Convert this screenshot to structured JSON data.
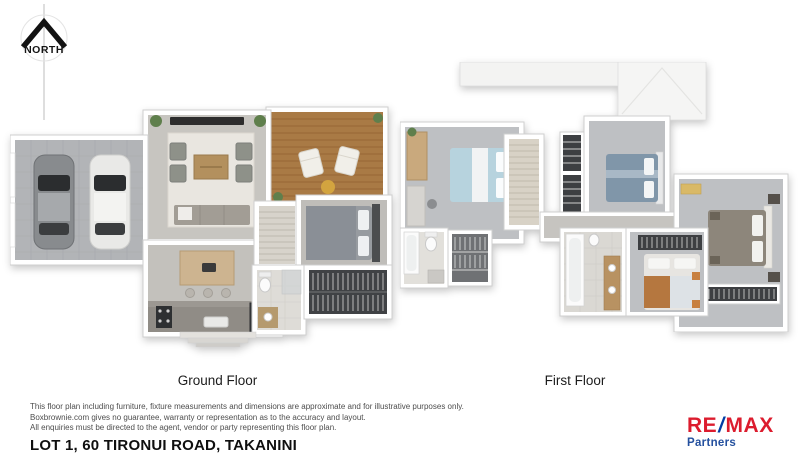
{
  "north": {
    "label": "NORTH"
  },
  "floors": {
    "ground": {
      "label": "Ground Floor"
    },
    "first": {
      "label": "First Floor"
    }
  },
  "footer": {
    "disclaimer_lines": [
      "This floor plan including furniture, fixture measurements and dimensions are approximate and for illustrative purposes only.",
      "Boxbrownie.com gives no guarantee, warranty or representation as to the accuracy and layout.",
      "All enquiries must be directed to the agent, vendor or party representing this floor plan."
    ],
    "address": "LOT 1, 60 TIRONUI ROAD, TAKANINI"
  },
  "brand": {
    "re": "RE",
    "slash": "/",
    "max": "MAX",
    "subtitle": "Partners",
    "colors": {
      "red": "#DC1C2E",
      "blue": "#003DA5"
    }
  },
  "colors": {
    "deck_wood": "#A97A45",
    "floor_grey": "#BFC0C2",
    "garage_floor": "#B2B4B7",
    "wall_white": "#FFFFFF",
    "wardrobe_dark": "#3F4144"
  }
}
